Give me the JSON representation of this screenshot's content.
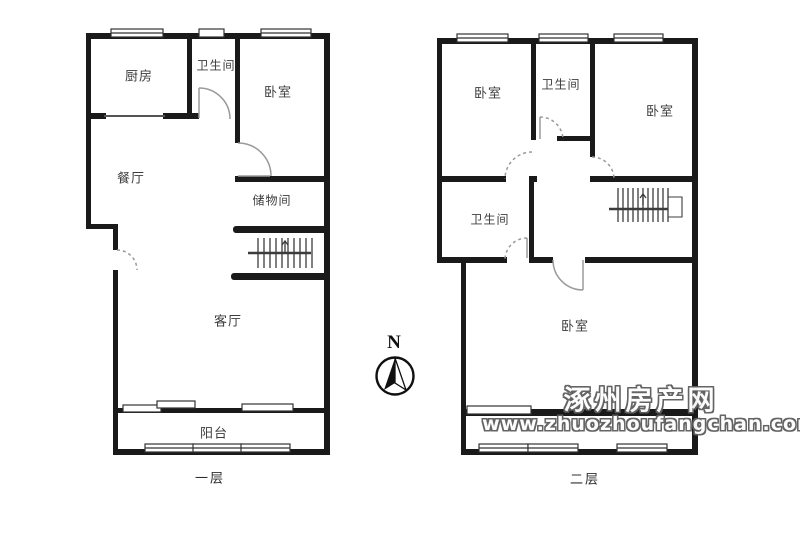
{
  "colors": {
    "wall": "#1a1a1a",
    "thin_line": "#3c3c3c",
    "door_arc": "#9a9a9a",
    "label_text": "#3d3d3d",
    "watermark_fill": "#fdfdfd",
    "watermark_outline": "#5e5e5e",
    "background": "#ffffff"
  },
  "floor1": {
    "title": "一层",
    "rooms": {
      "kitchen": "厨房",
      "bathroom": "卫生间",
      "bedroom": "卧室",
      "dining": "餐厅",
      "storage": "储物间",
      "living": "客厅",
      "balcony": "阳台"
    }
  },
  "floor2": {
    "title": "二层",
    "rooms": {
      "bedroom_left": "卧室",
      "bathroom_top": "卫生间",
      "bedroom_right": "卧室",
      "bathroom_mid": "卫生间",
      "bedroom_main": "卧室"
    }
  },
  "compass": {
    "north_label": "N"
  },
  "watermark": {
    "site_name": "涿州房产网",
    "site_url": "www.zhuozhoufangchan.com"
  }
}
